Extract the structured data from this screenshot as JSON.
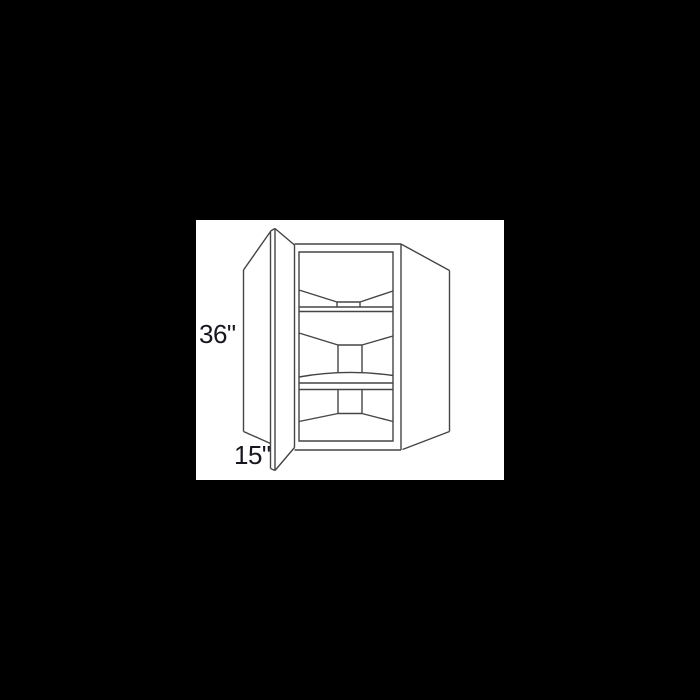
{
  "scene": {
    "background_color": "#000000",
    "panel": {
      "background_color": "#ffffff"
    }
  },
  "diagram": {
    "subject": "corner-wall-cabinet-line-drawing",
    "line_color": "#454545",
    "stroke_width": 1.4,
    "label_color": "#17171f",
    "labels": {
      "height": "36\"",
      "depth": "15\""
    },
    "parts": [
      {
        "name": "door-outer-edge",
        "d": "M74.5,11 L74.5,248.5"
      },
      {
        "name": "door-inner-edge",
        "d": "M79,8.5 L79,250.5"
      },
      {
        "name": "door-top-cap",
        "d": "M74.5,11 L79,8.5"
      },
      {
        "name": "door-bottom-cap",
        "d": "M74.5,248.5 L79,250.5"
      },
      {
        "name": "door-top-edge",
        "d": "M79,8.5 L98.5,25"
      },
      {
        "name": "door-bottom-edge",
        "d": "M79,250.5 L98.5,227.5"
      },
      {
        "name": "door-hinge-edge",
        "d": "M98.5,25 L98.5,227.5"
      },
      {
        "name": "left-wing-top-edge",
        "d": "M74.5,11.5 L47.5,50"
      },
      {
        "name": "left-wing-side-edge",
        "d": "M47.5,50 L47.5,211.5"
      },
      {
        "name": "left-wing-bottom-edge",
        "d": "M47.5,211.5 L74.5,223.5"
      },
      {
        "name": "right-wing-top-edge",
        "d": "M205,24 L253.5,50.5"
      },
      {
        "name": "right-wing-side-edge",
        "d": "M253.5,50.5 L253.5,211.5"
      },
      {
        "name": "right-wing-bottom-edge",
        "d": "M253.5,211.5 L206.5,229.5"
      },
      {
        "name": "face-frame-top-edge",
        "d": "M98.5,24 L205,24"
      },
      {
        "name": "face-frame-right-edge",
        "d": "M205,24 L205,230"
      },
      {
        "name": "face-frame-bottom-edge",
        "d": "M98.5,230 L205,230"
      },
      {
        "name": "face-frame-opening",
        "d": "M103,32 L197,32 L197,221 L103,221 Z"
      },
      {
        "name": "shelf1-left-slope",
        "d": "M103,70 L141,82"
      },
      {
        "name": "shelf1-center-edge",
        "d": "M141,82 L164,82"
      },
      {
        "name": "shelf1-right-slope",
        "d": "M164,82 L197,71"
      },
      {
        "name": "shelf1-post-left",
        "d": "M141,82 L141,87"
      },
      {
        "name": "shelf1-post-right",
        "d": "M164,82 L164,87"
      },
      {
        "name": "shelf1-band-top",
        "d": "M103,87 L197,87"
      },
      {
        "name": "shelf1-band-bottom",
        "d": "M103,91.5 L197,91.5"
      },
      {
        "name": "shelf2-left-slope",
        "d": "M103,113 L142,125"
      },
      {
        "name": "shelf2-post-top",
        "d": "M142,125 L166,125"
      },
      {
        "name": "shelf2-right-slope",
        "d": "M166,125 L197,116"
      },
      {
        "name": "shelf2-post-left",
        "d": "M142,125 L142,153"
      },
      {
        "name": "shelf2-post-right",
        "d": "M166,125 L166,153"
      },
      {
        "name": "shelf2-front-arc",
        "d": "M103,157 Q150,148.8 197,155.5"
      },
      {
        "name": "shelf2-band-top",
        "d": "M103,163 L197,163"
      },
      {
        "name": "shelf2-band-bottom",
        "d": "M103,169.5 L197,169.5"
      },
      {
        "name": "floor-post-left",
        "d": "M142,169.5 L142,193.5"
      },
      {
        "name": "floor-post-right",
        "d": "M166,169.5 L166,193.5"
      },
      {
        "name": "floor-post-bottom",
        "d": "M142,193.5 L166,193.5"
      },
      {
        "name": "floor-left-slope",
        "d": "M142,193.5 L103,201.5"
      },
      {
        "name": "floor-right-slope",
        "d": "M166,193.5 L197,201.5"
      }
    ]
  }
}
